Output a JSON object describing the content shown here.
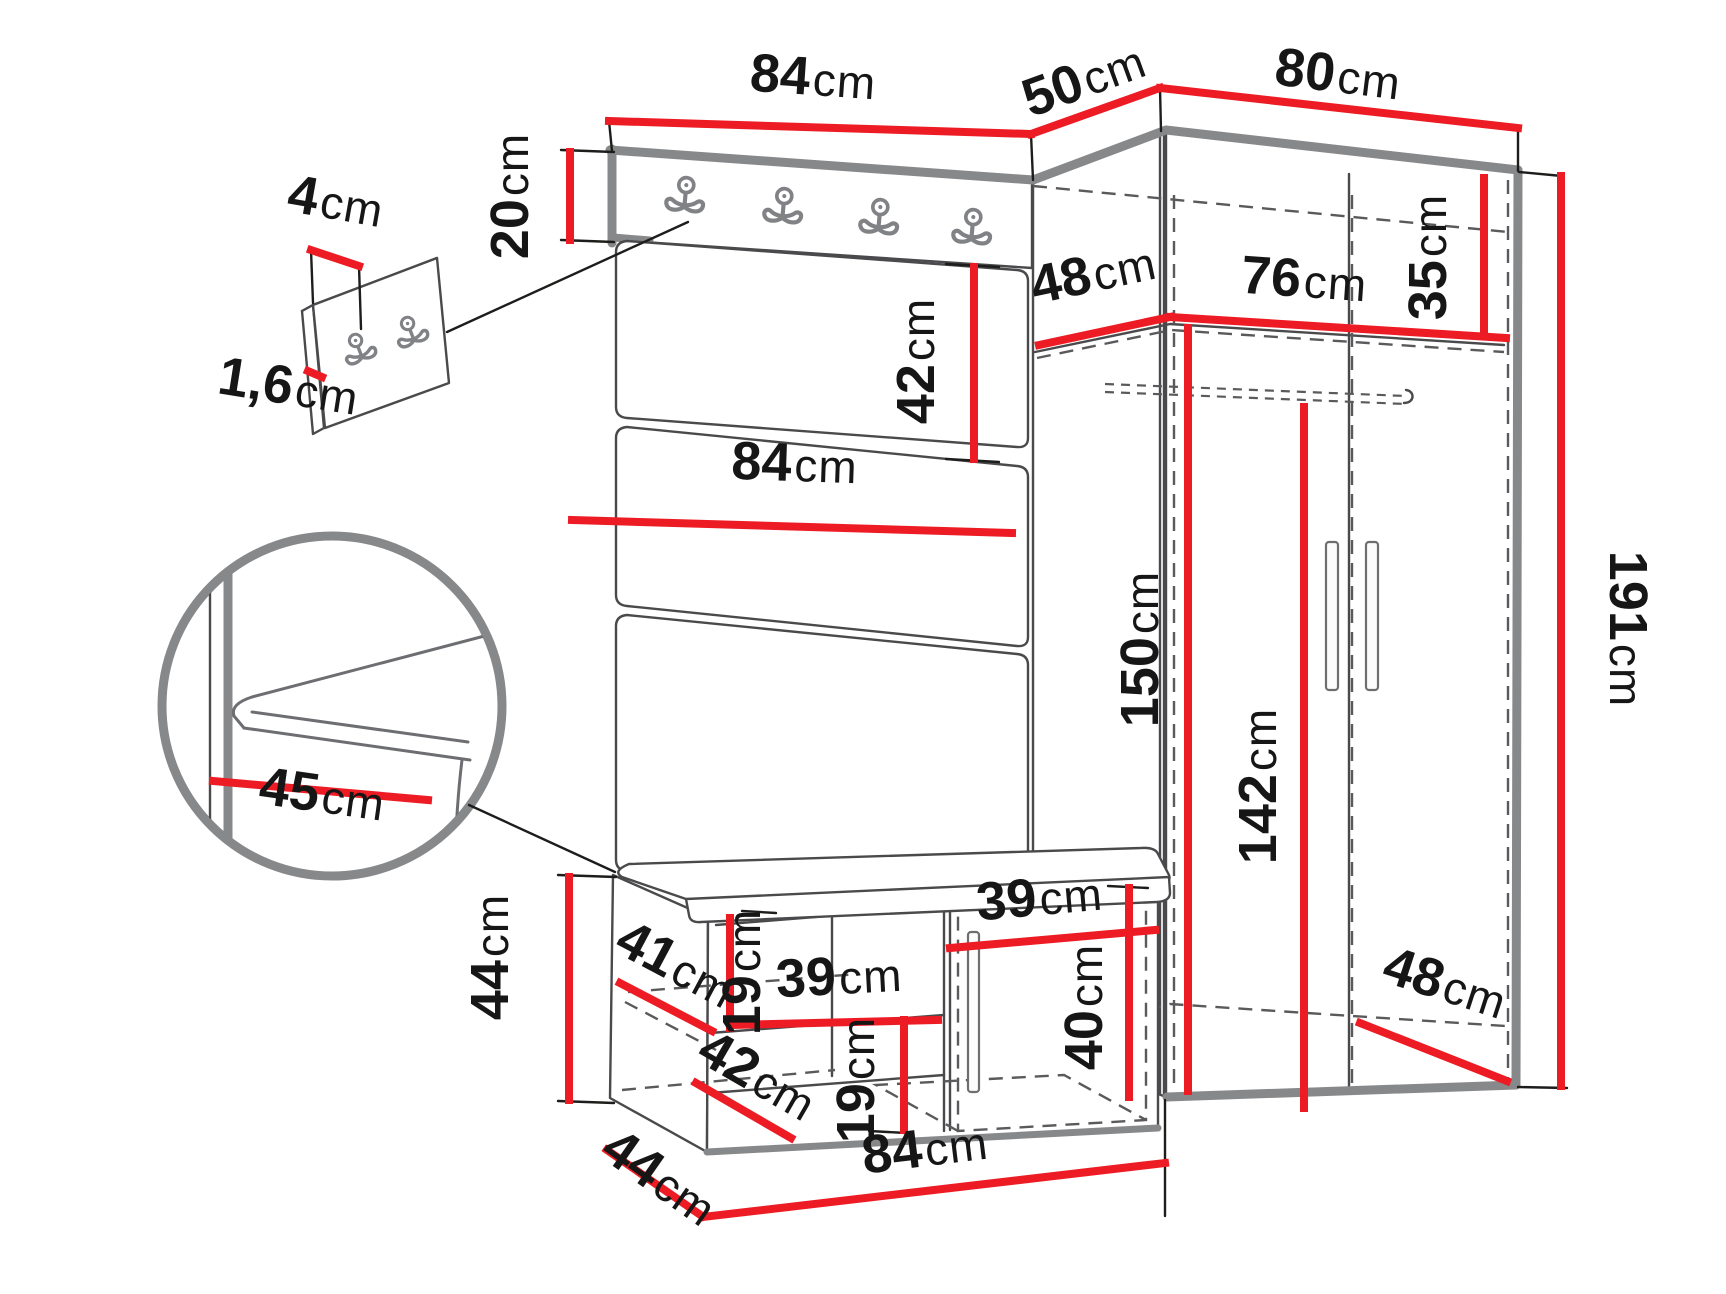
{
  "diagram": {
    "kind": "furniture-dimension-diagram",
    "subject": "hallway set: coat-rack wall panel with hooks, upholstered panels, shoe bench and corner wardrobe",
    "unit": "cm",
    "colors": {
      "dimension_line": "#ed1c24",
      "outline_thick": "#87888a",
      "outline_thin": "#4a4a4c",
      "text": "#161616"
    }
  },
  "labels": {
    "top_width": {
      "v": "84",
      "u": "cm"
    },
    "corner_depth": {
      "v": "50",
      "u": "cm"
    },
    "wardrobe_width": {
      "v": "80",
      "u": "cm"
    },
    "header_height": {
      "v": "20",
      "u": "cm"
    },
    "hook_strip_width": {
      "v": "4",
      "u": "cm"
    },
    "hook_strip_thickness": {
      "v": "1,6",
      "u": "cm"
    },
    "panel_height": {
      "v": "42",
      "u": "cm"
    },
    "shelf_depth": {
      "v": "48",
      "u": "cm"
    },
    "shelf_width": {
      "v": "76",
      "u": "cm"
    },
    "top_shelf_height": {
      "v": "35",
      "u": "cm"
    },
    "panel_width": {
      "v": "84",
      "u": "cm"
    },
    "seat_depth": {
      "v": "45",
      "u": "cm"
    },
    "interior_height": {
      "v": "150",
      "u": "cm"
    },
    "door_height": {
      "v": "142",
      "u": "cm"
    },
    "total_height": {
      "v": "191",
      "u": "cm"
    },
    "bench_height": {
      "v": "44",
      "u": "cm"
    },
    "bench_top_depth": {
      "v": "41",
      "u": "cm"
    },
    "bench_gap_upper": {
      "v": "19",
      "u": "cm"
    },
    "bench_shelf_width": {
      "v": "39",
      "u": "cm"
    },
    "bench_lower_depth": {
      "v": "42",
      "u": "cm"
    },
    "bench_gap_lower": {
      "v": "19",
      "u": "cm"
    },
    "bench_depth": {
      "v": "44",
      "u": "cm"
    },
    "bench_width": {
      "v": "84",
      "u": "cm"
    },
    "bench_door_width": {
      "v": "39",
      "u": "cm"
    },
    "bench_door_height": {
      "v": "40",
      "u": "cm"
    },
    "wardrobe_depth": {
      "v": "48",
      "u": "cm"
    }
  }
}
